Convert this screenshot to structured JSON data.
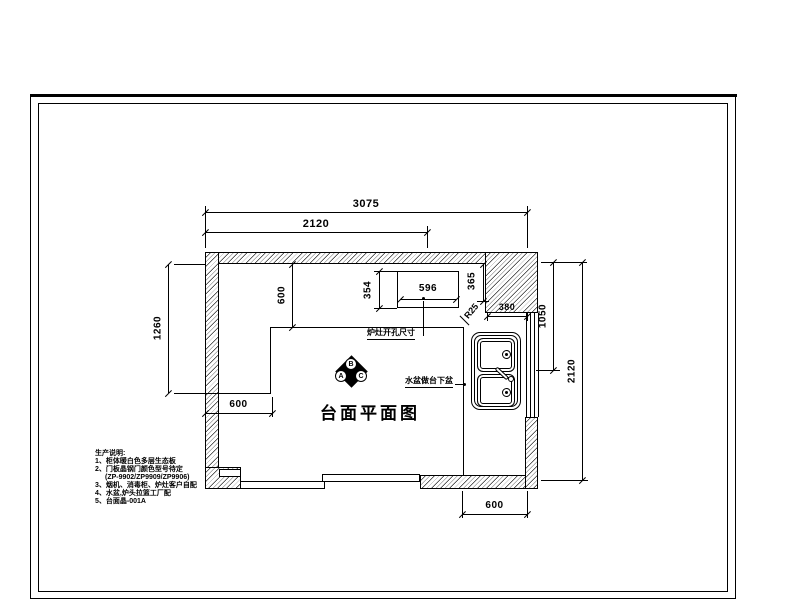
{
  "drawing": {
    "title": "台面平面图",
    "dims": {
      "d3075": "3075",
      "d2120_top": "2120",
      "d1260": "1260",
      "d600_depth": "600",
      "d600_left": "600",
      "d596": "596",
      "d354": "354",
      "d365": "365",
      "d380": "380",
      "d1050": "1050",
      "d2120_right": "2120",
      "d600_bottom": "600",
      "r25": "R25"
    },
    "labels": {
      "cooktop_cutout": "炉灶开孔尺寸",
      "sink_undermount": "水盆做台下盆"
    },
    "marker": {
      "a": "A",
      "b": "B",
      "c": "C"
    },
    "notes": {
      "heading": "生产说明:",
      "items": [
        "1、柜体暖白色多层生态板",
        "2、门板晶钢门颜色型号待定",
        "(ZP-9902/ZP9909/ZP9906)",
        "3、烟机、消毒柜、炉灶客户自配",
        "4、水盆,炉头拉篮工厂配",
        "5、台面晶-001A"
      ]
    }
  }
}
